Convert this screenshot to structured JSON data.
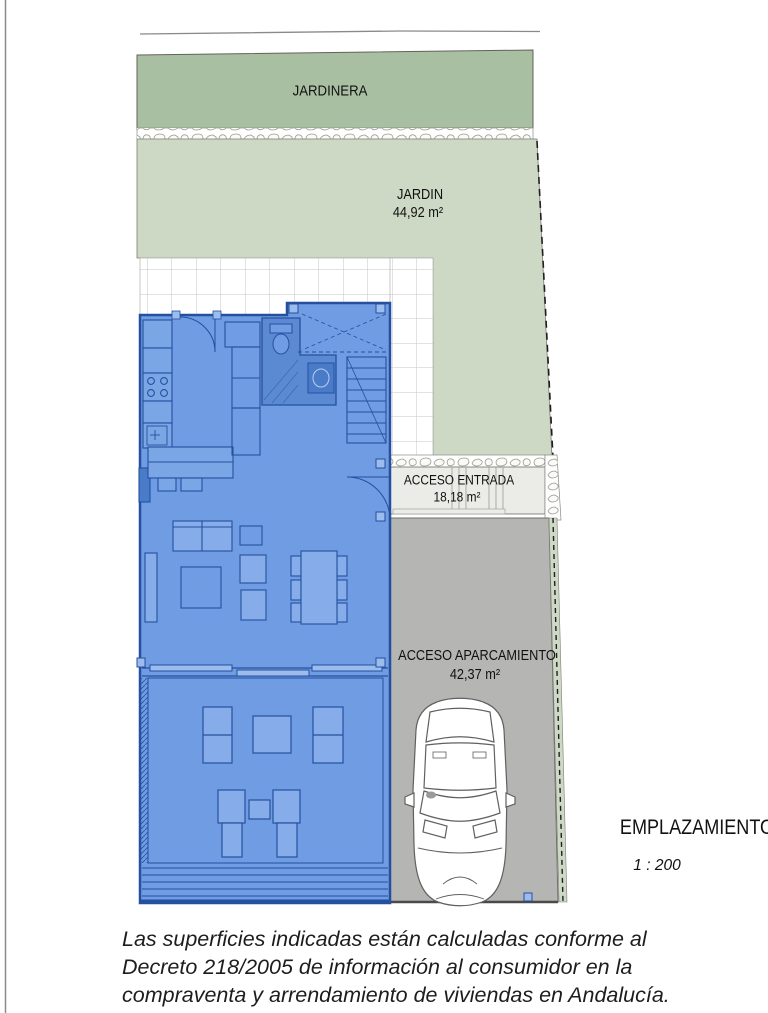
{
  "plan": {
    "jardinera_label": "JARDINERA",
    "jardin": {
      "name": "JARDIN",
      "area": "44,92 m²"
    },
    "acceso_entrada": {
      "name": "ACCESO ENTRADA",
      "area": "18,18 m²"
    },
    "acceso_aparcamiento": {
      "name": "ACCESO APARCAMIENTO",
      "area": "42,37 m²"
    }
  },
  "title_block": {
    "title": "EMPLAZAMIENTO",
    "scale": "1 : 200"
  },
  "footer": {
    "lines": [
      "Las superficies indicadas están calculadas conforme al",
      "Decreto 218/2005 de información al consumidor en la",
      "compraventa y arrendamiento de viviendas en Andalucía."
    ]
  },
  "colors": {
    "house_fill": "#6f9ce3",
    "house_line": "#24509f",
    "bathroom_fill": "#5b8ad3",
    "planter_green": "#a9bfa2",
    "garden_green": "#cdd8c5",
    "parking_gray": "#b5b5b3",
    "entrance_gray": "#ebebe7",
    "text": "#111111"
  }
}
